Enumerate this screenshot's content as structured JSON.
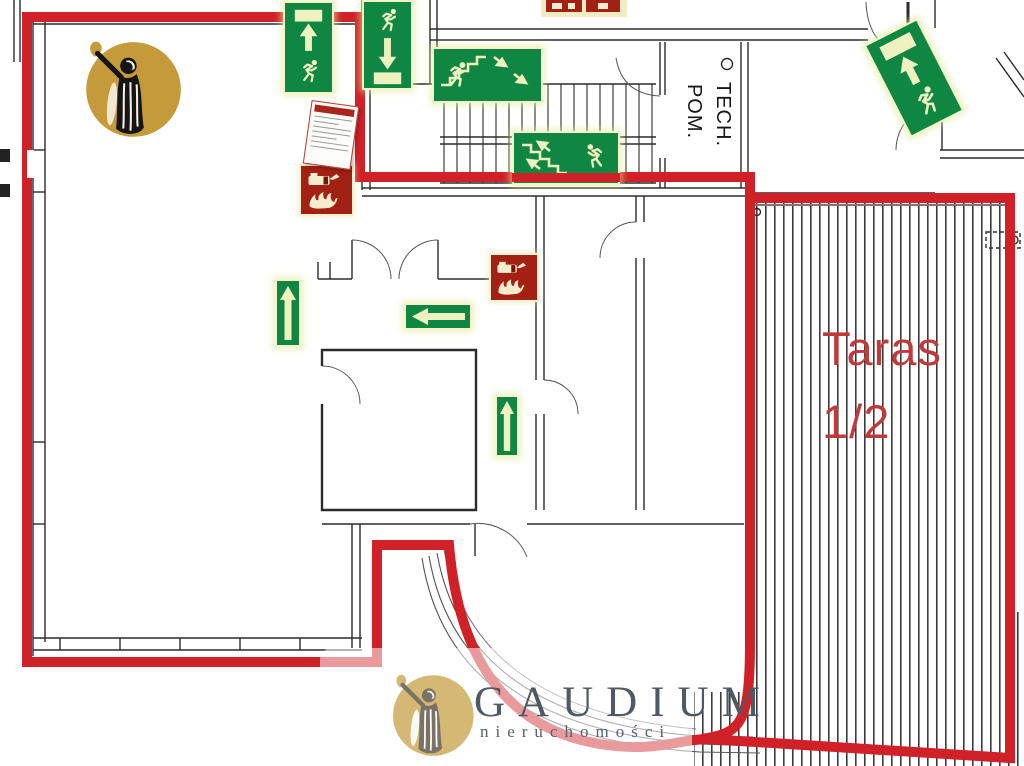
{
  "colors": {
    "boundary_red": "#cf2127",
    "sign_green": "#0f8742",
    "glyph_cream": "#eef2c0",
    "ext_red": "#a32015",
    "gold": "#c49a3a",
    "gold_light": "#d5b873",
    "brand_text": "#4e5963",
    "terrace_text": "#c03a3c",
    "wall": "#2b2b2b"
  },
  "labels": {
    "terrace_line1": "Taras",
    "terrace_line2": "1/2",
    "tech_room_line1": "POM.",
    "tech_room_line2": "TECH."
  },
  "watermark": {
    "brand": "GAUDIUM",
    "subtitle": "nieruchomości"
  },
  "signs": {
    "evacuation": [
      {
        "id": "exit-route-up-left",
        "elements": [
          "exit-door",
          "up-arrow",
          "running-man"
        ]
      },
      {
        "id": "exit-route-down",
        "elements": [
          "running-man",
          "down-arrow",
          "exit-door"
        ]
      },
      {
        "id": "stairs-down-right",
        "elements": [
          "running-man",
          "stairs",
          "down-right-arrows"
        ]
      },
      {
        "id": "stairs-up-left",
        "elements": [
          "stairs",
          "up-left-arrows",
          "running-man"
        ]
      },
      {
        "id": "exit-route-up-rotated",
        "elements": [
          "exit-door",
          "up-arrow",
          "running-man"
        ]
      },
      {
        "id": "direction-up-1",
        "elements": [
          "up-arrow"
        ]
      },
      {
        "id": "direction-left",
        "elements": [
          "left-arrow"
        ]
      },
      {
        "id": "direction-up-2",
        "elements": [
          "up-arrow"
        ]
      }
    ],
    "fire": [
      {
        "id": "fire-extinguisher-1",
        "elements": [
          "fire-extinguisher",
          "flames"
        ]
      },
      {
        "id": "fire-extinguisher-2",
        "elements": [
          "fire-extinguisher",
          "flames"
        ]
      },
      {
        "id": "partial-red-signs-top-edge",
        "count": 2
      }
    ],
    "documents": [
      {
        "id": "fire-instruction-sheet"
      }
    ]
  }
}
